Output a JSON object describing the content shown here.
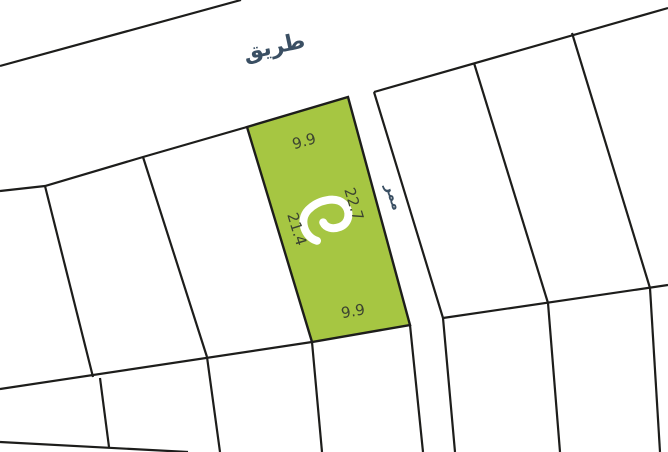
{
  "map": {
    "canvas": {
      "width": 668,
      "height": 452,
      "background_color": "#ffffff"
    },
    "style": {
      "line_color": "#1d1d1b",
      "line_width": 2.2,
      "road_label_color": "#3a4f63",
      "dimension_label_color": "#3b4330"
    },
    "highlight_plot": {
      "fill_color": "#a6c642",
      "points": "247,127 348,97 410,325 312,342",
      "dimensions": {
        "top": "9.9",
        "right": "22.7",
        "left": "21.4",
        "bottom": "9.9"
      }
    },
    "labels": [
      {
        "name": "road-label",
        "text": "طريق",
        "x": 274,
        "y": 46,
        "rotate": -12,
        "size": 22,
        "weight": "700",
        "color": "#3a4f63"
      },
      {
        "name": "passage-label",
        "text": "ممر",
        "x": 394,
        "y": 197,
        "rotate": 73,
        "size": 14,
        "weight": "700",
        "color": "#3a4f63"
      },
      {
        "name": "dimension-top",
        "text": "9.9",
        "x": 304,
        "y": 141,
        "rotate": -16,
        "size": 15,
        "weight": "400",
        "color": "#3b4330"
      },
      {
        "name": "dimension-right",
        "text": "22.7",
        "x": 354,
        "y": 204,
        "rotate": 73,
        "size": 15,
        "weight": "400",
        "color": "#3b4330"
      },
      {
        "name": "dimension-left",
        "text": "21.4",
        "x": 297,
        "y": 229,
        "rotate": 73,
        "size": 15,
        "weight": "400",
        "color": "#3b4330"
      },
      {
        "name": "dimension-bottom",
        "text": "9.9",
        "x": 353,
        "y": 311,
        "rotate": -10,
        "size": 15,
        "weight": "400",
        "color": "#3b4330"
      }
    ],
    "lines": [
      {
        "name": "road-upper-edge",
        "points": "0,66 241,0"
      },
      {
        "name": "right-block-top-edge",
        "points": "374,92 668,8"
      },
      {
        "name": "left-block-top-edge",
        "points": "0,191 45,186 143,157 247,127"
      },
      {
        "name": "passage-right-edge",
        "points": "374,92 443,318 455,452"
      },
      {
        "name": "passage-left-edge-lower",
        "points": "410,325 423,452"
      },
      {
        "name": "left-block-bottom-boundary",
        "points": "0,389 312,342"
      },
      {
        "name": "right-block-bottom-boundary",
        "points": "443,318 668,285"
      },
      {
        "name": "left-divider-1",
        "points": "45,186 93,377"
      },
      {
        "name": "left-divider-2",
        "points": "143,157 207,357"
      },
      {
        "name": "lower-divider-1",
        "points": "100,378 109,447"
      },
      {
        "name": "lower-divider-2",
        "points": "207,357 220,452"
      },
      {
        "name": "lower-divider-3",
        "points": "312,342 322,452"
      },
      {
        "name": "right-divider-1",
        "points": "474,63 548,303"
      },
      {
        "name": "right-divider-2",
        "points": "572,33 650,288"
      },
      {
        "name": "lower-divider-4",
        "points": "548,303 560,452"
      },
      {
        "name": "lower-divider-5",
        "points": "650,288 660,452"
      },
      {
        "name": "bottom-left-boundary",
        "points": "0,442 188,452"
      }
    ],
    "logo": {
      "color": "#ffffff",
      "x": 328,
      "y": 221,
      "rotate": -16,
      "stroke_width": 8,
      "path": "M -16 16 C -27 9 -28 -9 -16 -16 C -4 -23 14 -22 20 -12 C 25 -3 20 8 10 9 C 2 9.7 -4 6 -5 0"
    }
  }
}
